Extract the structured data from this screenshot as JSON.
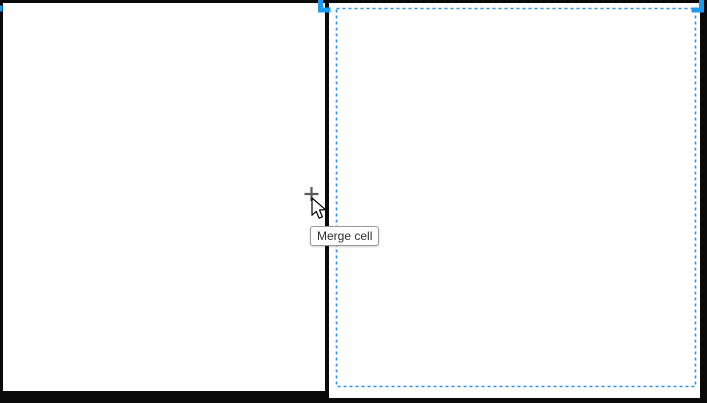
{
  "window": {
    "description": "Document table editor canvas (zoomed), two-cell table with right cell selected"
  },
  "table": {
    "left_cell": {
      "content": "",
      "selected": false
    },
    "right_cell": {
      "content": "",
      "selected": true
    }
  },
  "selection": {
    "handle_icon": "corner-bracket",
    "style": "dashed-inset-border"
  },
  "tooltip": {
    "label": "Merge cell"
  },
  "cursor": {
    "type": "arrow-pointer-with-plus"
  },
  "colors": {
    "handle_blue": "#1E9BF0",
    "dash_blue": "#2E95EE",
    "border_color": "#0A0A0A",
    "cell_bg": "#FFFFFF",
    "tooltip_bg": "#FEFEFE",
    "tooltip_border": "#9A9A9A",
    "tooltip_text": "#2E2E2E",
    "plus_gray": "#4A4A4A"
  }
}
